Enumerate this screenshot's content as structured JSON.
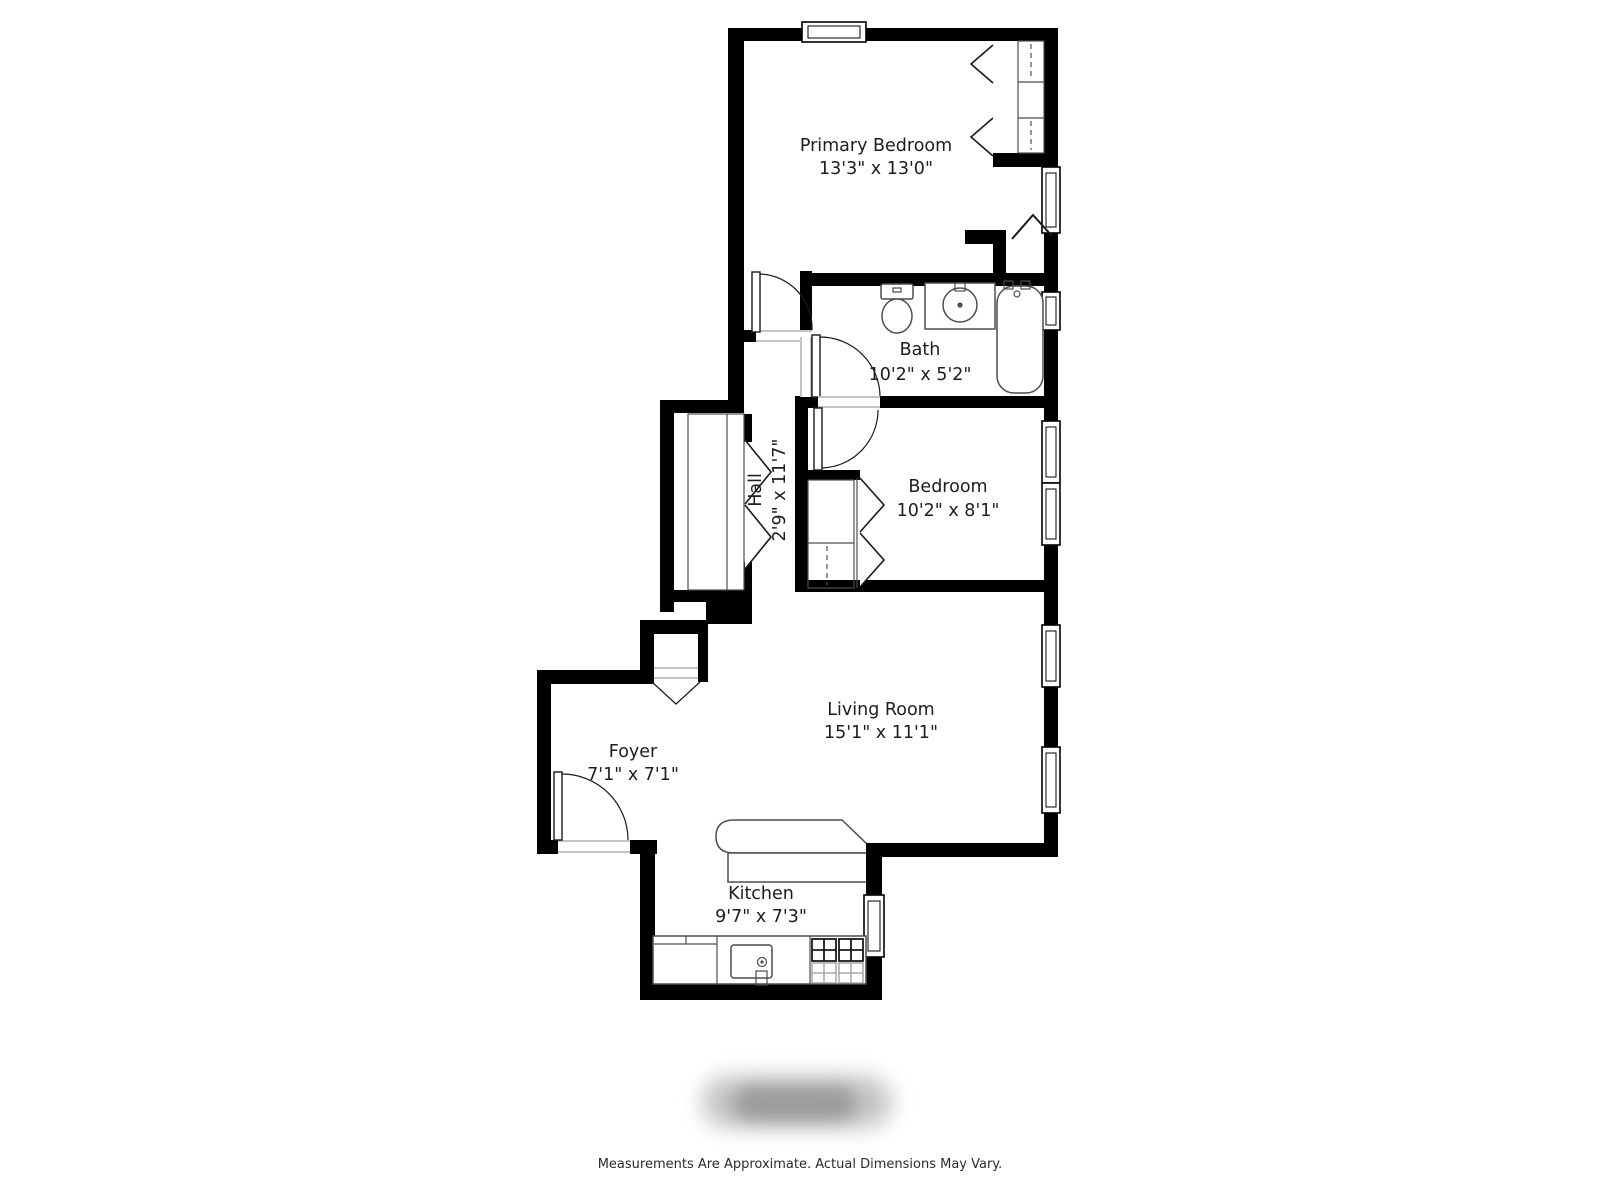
{
  "floor_plan": {
    "rooms": [
      {
        "name": "Primary Bedroom",
        "dims": "13'3\" x 13'0\""
      },
      {
        "name": "Bath",
        "dims": "10'2\" x 5'2\""
      },
      {
        "name": "Hall",
        "dims": "2'9\" x 11'7\""
      },
      {
        "name": "Bedroom",
        "dims": "10'2\" x 8'1\""
      },
      {
        "name": "Living Room",
        "dims": "15'1\" x 11'1\""
      },
      {
        "name": "Foyer",
        "dims": "7'1\" x 7'1\""
      },
      {
        "name": "Kitchen",
        "dims": "9'7\" x 7'3\""
      }
    ],
    "disclaimer": "Measurements Are Approximate. Actual Dimensions May Vary.",
    "colors": {
      "wall": "#000000",
      "fixture_line": "#4d4d4d",
      "text": "#1d1d1d",
      "background": "#ffffff",
      "watermark": "#b5b5b5"
    }
  }
}
